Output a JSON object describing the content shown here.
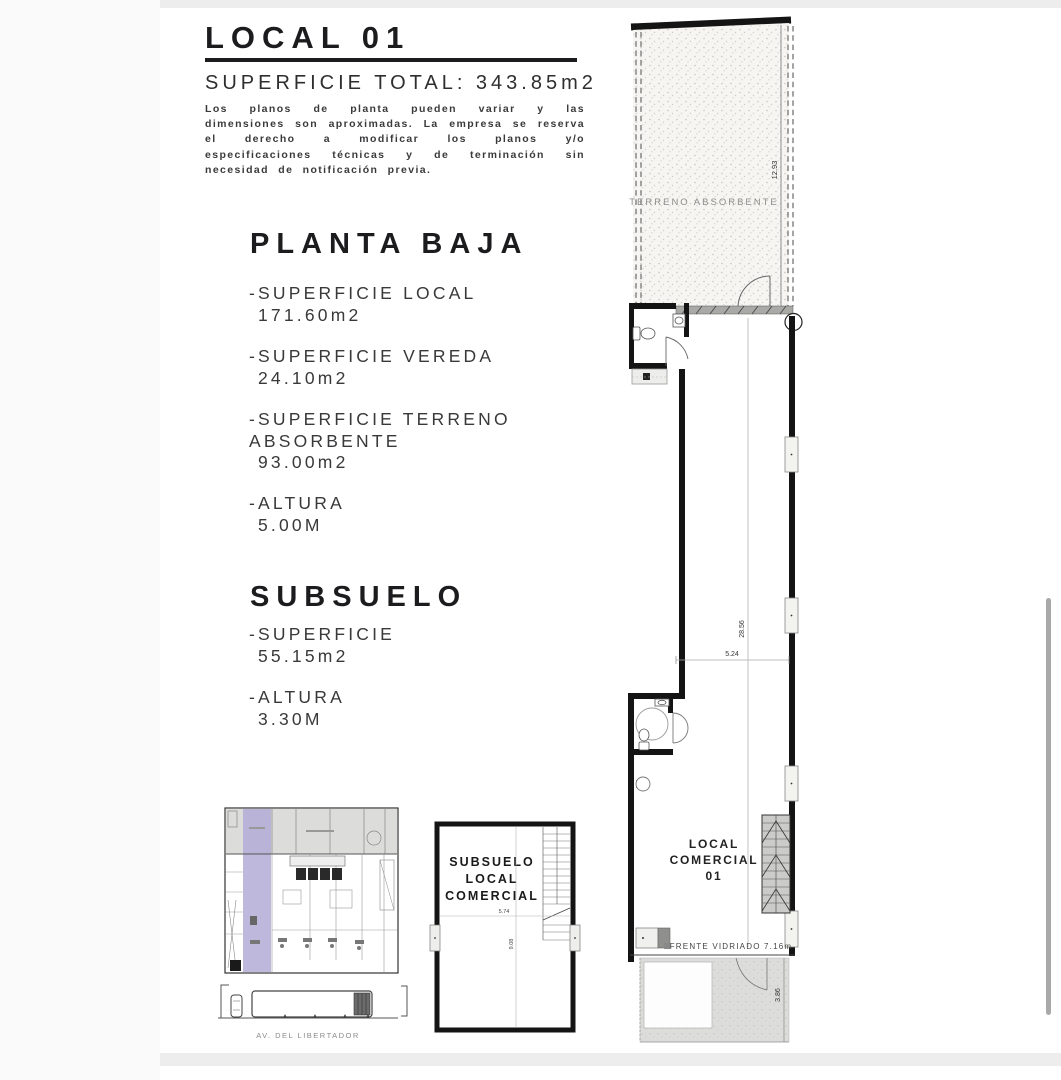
{
  "header": {
    "title": "LOCAL 01",
    "subtitle": "SUPERFICIE TOTAL: 343.85m2",
    "disclaimer": "Los planos de planta pueden variar y las dimensiones son aproximadas. La empresa se reserva el derecho a modificar los planos y/o especificaciones técnicas y de terminación sin necesidad de notificación previa."
  },
  "planta_baja": {
    "heading": "PLANTA BAJA",
    "items": [
      {
        "label": "-SUPERFICIE LOCAL",
        "value": "171.60m2"
      },
      {
        "label": "-SUPERFICIE VEREDA",
        "value": "24.10m2"
      },
      {
        "label": "-SUPERFICIE TERRENO ABSORBENTE",
        "value": "93.00m2"
      },
      {
        "label": "-ALTURA",
        "value": "5.00M"
      }
    ]
  },
  "subsuelo": {
    "heading": "SUBSUELO",
    "items": [
      {
        "label": "-SUPERFICIE",
        "value": "55.15m2"
      },
      {
        "label": "-ALTURA",
        "value": "3.30M"
      }
    ]
  },
  "main_plan": {
    "terreno_label": "TERRENO  ABSORBENTE",
    "dim_terreno_depth": "12.93",
    "dim_interior_depth": "28.56",
    "dim_interior_width": "5.24",
    "unit_line1": "LOCAL",
    "unit_line2": "COMERCIAL",
    "unit_line3": "01",
    "frente_label": "FRENTE VIDRIADO 7.16m",
    "dim_vereda_depth": "3.86"
  },
  "subsuelo_plan": {
    "line1": "SUBSUELO",
    "line2": "LOCAL",
    "line3": "COMERCIAL",
    "dim_width": "5.74",
    "dim_depth": "9.08"
  },
  "site_plan": {
    "street_label": "AV. DEL LIBERTADOR",
    "highlight_color": "#b4abd7"
  }
}
